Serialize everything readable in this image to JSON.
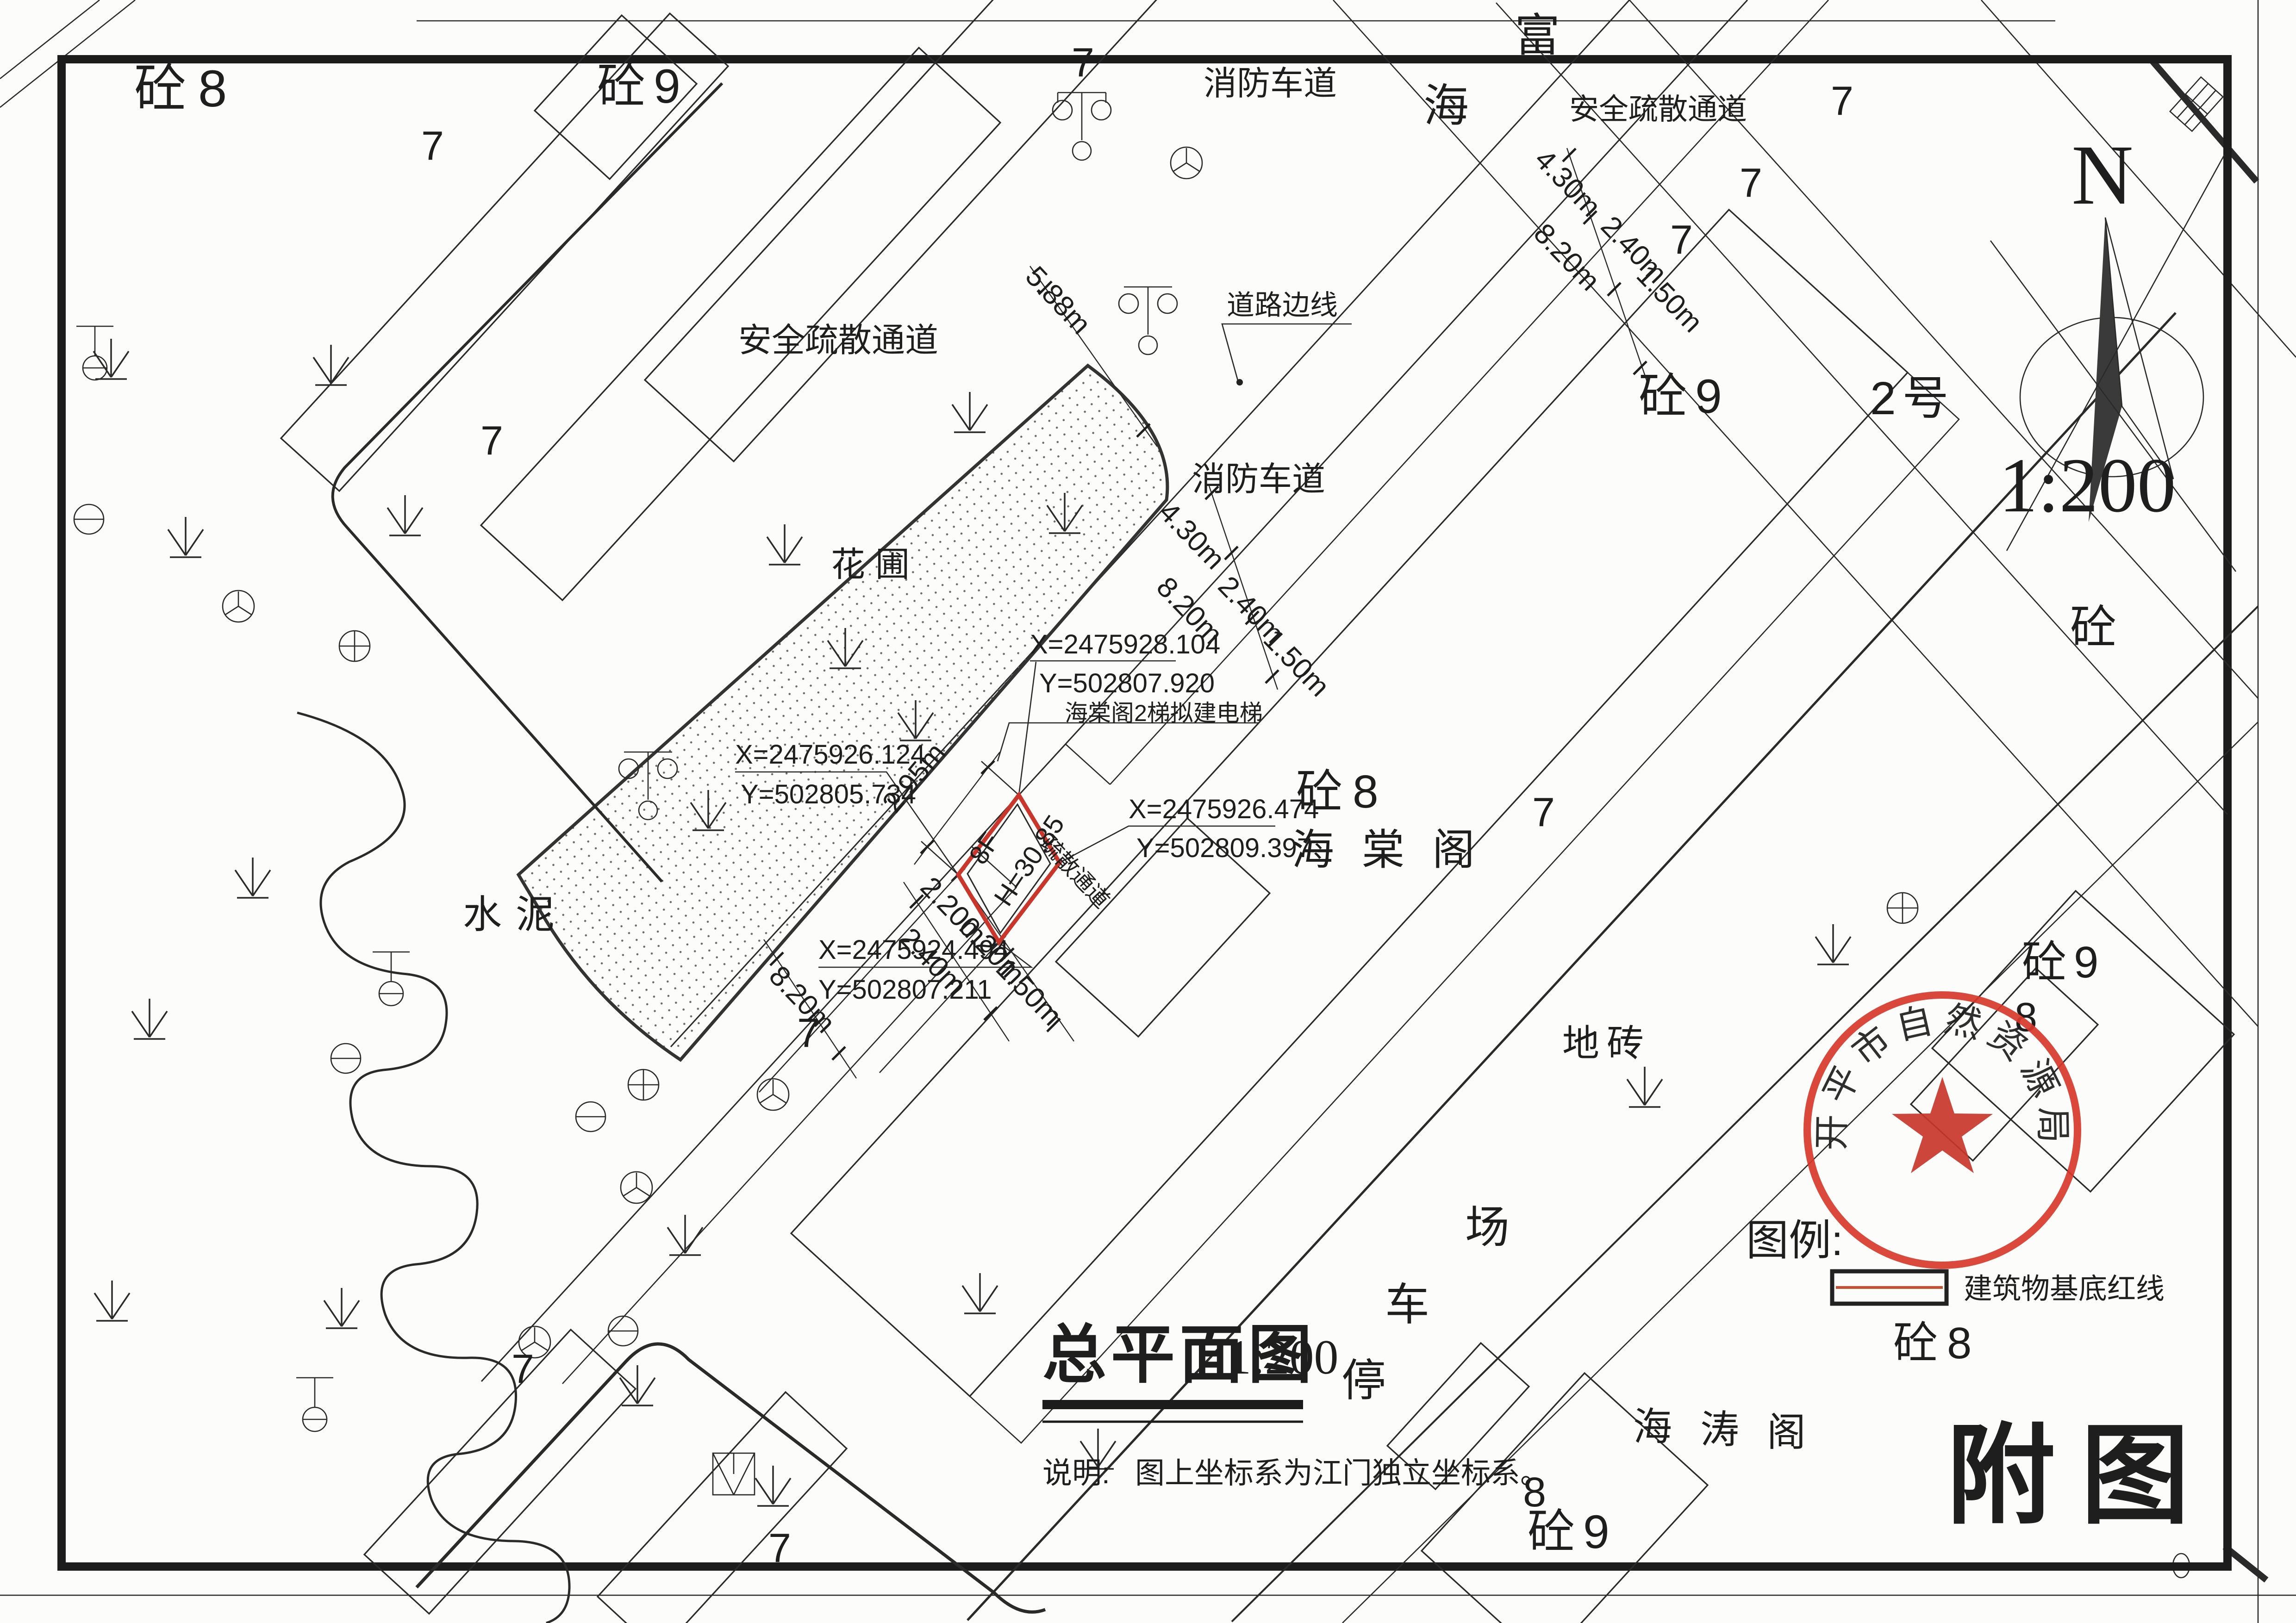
{
  "drawing": {
    "title": "总平面图",
    "title_scale": "1:200",
    "note_label": "说明:",
    "note_text": "图上坐标系为江门独立坐标系。",
    "corner_mark": "附图",
    "compass_n": "N",
    "compass_scale": "1:200",
    "stamp_text": "开平市自然资源局",
    "legend_label": "图例:",
    "legend_item": "建筑物基底红线"
  },
  "coordinates": {
    "top": {
      "x": "X=2475928.104",
      "y": "Y=502807.920"
    },
    "left": {
      "x": "X=2475926.124",
      "y": "Y=502805.734"
    },
    "right": {
      "x": "X=2475926.474",
      "y": "Y=502809.397"
    },
    "bottom": {
      "x": "X=2475924.494",
      "y": "Y=502807.211"
    }
  },
  "proposed": {
    "callout": "海棠阁2梯拟建电梯",
    "floors": "8F",
    "height": "H=30.85",
    "passage": "疏散通道"
  },
  "dimensions": {
    "d588": "5.88m",
    "d430": "4.30m",
    "d820": "8.20m",
    "d240": "2.40m",
    "d150": "1.50m",
    "d295": "2.95m",
    "d220": "2.20m",
    "d020": "0.20m"
  },
  "labels": {
    "fire_lane": "消防车道",
    "safe_passage": "安全疏散通道",
    "road_edge": "道路边线",
    "flower_bed": "花圃",
    "cement": "水泥",
    "floor_tile": "地砖",
    "haitang_tower": "海棠阁",
    "haitao_1": "海",
    "haitao_2": "涛",
    "haitao_3": "阁",
    "parking_1": "停",
    "parking_2": "车",
    "parking_3": "场",
    "street_1": "海",
    "street_2": "富",
    "block_no2": "2号",
    "tong8": "砼8",
    "tong9": "砼9",
    "tong": "砼",
    "floors7": "7",
    "floors8": "8",
    "zero": "0"
  }
}
